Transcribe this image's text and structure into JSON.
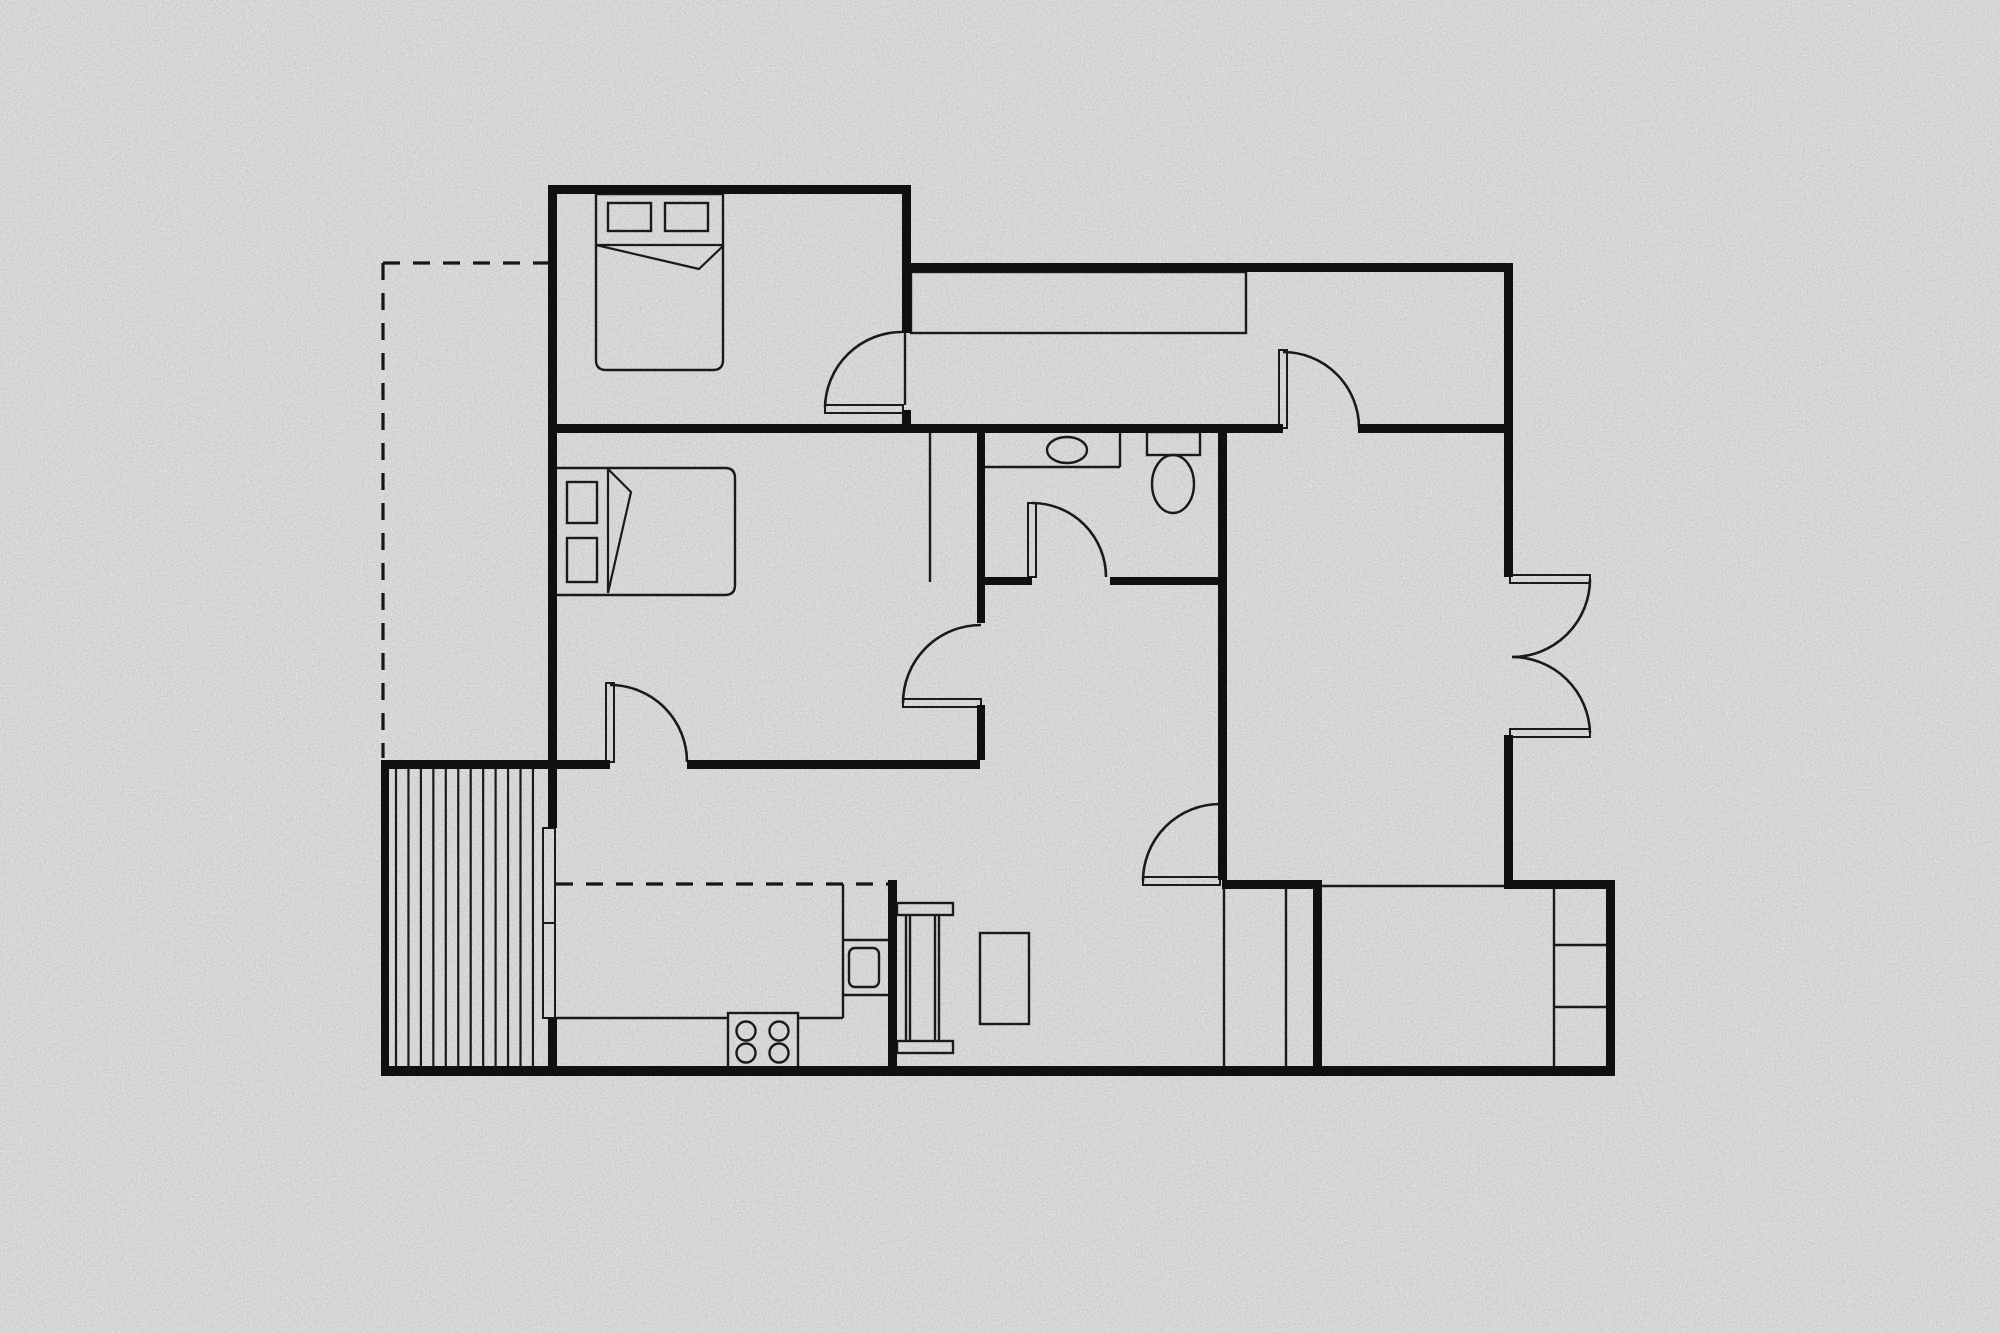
{
  "meta": {
    "title": "apartment-floor-plan",
    "canvas": {
      "w": 2000,
      "h": 1333
    }
  },
  "colors": {
    "background": "#cbcbcb",
    "wall": "#101010",
    "line": "#1a1a1a",
    "dash": "#161616"
  },
  "plan": {
    "walls": [
      {
        "name": "bedroom1-north-wall",
        "x": 548,
        "y": 185,
        "w": 363,
        "h": 9
      },
      {
        "name": "west-wall",
        "x": 548,
        "y": 185,
        "w": 9,
        "h": 643
      },
      {
        "name": "west-wall-lower",
        "x": 548,
        "y": 1018,
        "w": 9,
        "h": 58
      },
      {
        "name": "bedroom1-east-wall-upper",
        "x": 902,
        "y": 185,
        "w": 9,
        "h": 148
      },
      {
        "name": "bedroom1-east-wall-stub",
        "x": 902,
        "y": 410,
        "w": 9,
        "h": 23
      },
      {
        "name": "hallway-north-wall",
        "x": 904,
        "y": 263,
        "w": 609,
        "h": 9
      },
      {
        "name": "east-wall-upper",
        "x": 1504,
        "y": 272,
        "w": 9,
        "h": 305
      },
      {
        "name": "east-wall-mid",
        "x": 1504,
        "y": 735,
        "w": 9,
        "h": 154
      },
      {
        "name": "main-cross-wall-west",
        "x": 548,
        "y": 424,
        "w": 735,
        "h": 9
      },
      {
        "name": "main-cross-wall-east",
        "x": 1358,
        "y": 424,
        "w": 146,
        "h": 9
      },
      {
        "name": "bathroom-west-wall",
        "x": 977,
        "y": 433,
        "w": 8,
        "h": 190
      },
      {
        "name": "bathroom-west-wall-stub",
        "x": 977,
        "y": 705,
        "w": 8,
        "h": 55
      },
      {
        "name": "bathroom-south-wall-west",
        "x": 985,
        "y": 577,
        "w": 47,
        "h": 8
      },
      {
        "name": "bathroom-south-wall-east",
        "x": 1110,
        "y": 577,
        "w": 112,
        "h": 8
      },
      {
        "name": "livingroom-west-wall",
        "x": 1218,
        "y": 433,
        "w": 9,
        "h": 447
      },
      {
        "name": "deck-north-wall",
        "x": 381,
        "y": 760,
        "w": 229,
        "h": 9
      },
      {
        "name": "bedroom2-south-wall",
        "x": 687,
        "y": 760,
        "w": 293,
        "h": 9
      },
      {
        "name": "deck-west-wall",
        "x": 381,
        "y": 760,
        "w": 8,
        "h": 316
      },
      {
        "name": "south-wall",
        "x": 381,
        "y": 1066,
        "w": 1234,
        "h": 10
      },
      {
        "name": "kitchen-east-wall",
        "x": 888,
        "y": 880,
        "w": 9,
        "h": 186
      },
      {
        "name": "dining-closet-north-wall",
        "x": 1222,
        "y": 880,
        "w": 100,
        "h": 9
      },
      {
        "name": "dining-closet-east-wall",
        "x": 1313,
        "y": 880,
        "w": 9,
        "h": 186
      },
      {
        "name": "bottomright-north-wall",
        "x": 1507,
        "y": 880,
        "w": 108,
        "h": 9
      },
      {
        "name": "bottomright-east-wall",
        "x": 1606,
        "y": 880,
        "w": 9,
        "h": 196
      }
    ],
    "rects": [
      {
        "name": "hallway-closet",
        "x": 911,
        "y": 272,
        "w": 335,
        "h": 61,
        "sw": 2.4
      },
      {
        "name": "bed1-pillow-left",
        "x": 608,
        "y": 203,
        "w": 43,
        "h": 28,
        "sw": 2.4
      },
      {
        "name": "bed1-pillow-right",
        "x": 665,
        "y": 203,
        "w": 43,
        "h": 28,
        "sw": 2.4
      },
      {
        "name": "bed2-pillow-top",
        "x": 567,
        "y": 482,
        "w": 30,
        "h": 41,
        "sw": 2.4
      },
      {
        "name": "bed2-pillow-bottom",
        "x": 567,
        "y": 538,
        "w": 30,
        "h": 44,
        "sw": 2.4
      },
      {
        "name": "toilet-tank",
        "x": 1147,
        "y": 432,
        "w": 53,
        "h": 23,
        "sw": 2.4
      },
      {
        "name": "kitchen-sink",
        "x": 849,
        "y": 948,
        "w": 30,
        "h": 39,
        "rx": 6,
        "sw": 2.4
      },
      {
        "name": "stove",
        "x": 728,
        "y": 1013,
        "w": 70,
        "h": 59,
        "sw": 2.4
      },
      {
        "name": "dining-table-end-north",
        "x": 897,
        "y": 903,
        "w": 56,
        "h": 12,
        "sw": 2.4
      },
      {
        "name": "dining-table-end-south",
        "x": 897,
        "y": 1041,
        "w": 56,
        "h": 12,
        "sw": 2.4
      },
      {
        "name": "coffee-table",
        "x": 980,
        "y": 933,
        "w": 49,
        "h": 91,
        "sw": 2.4
      },
      {
        "name": "sliding-door-panel-upper",
        "x": 543,
        "y": 828,
        "w": 12,
        "h": 95,
        "sw": 2
      },
      {
        "name": "sliding-door-panel-lower",
        "x": 543,
        "y": 923,
        "w": 12,
        "h": 95,
        "sw": 2
      }
    ],
    "door_leaves": [
      {
        "name": "bedroom1-door-leaf",
        "x": 825,
        "y": 405,
        "w": 78,
        "h": 8
      },
      {
        "name": "hallway-door-leaf",
        "x": 1279,
        "y": 350,
        "w": 8,
        "h": 78
      },
      {
        "name": "bathroom-door-leaf",
        "x": 1028,
        "y": 503,
        "w": 8,
        "h": 74
      },
      {
        "name": "bedroom2-east-door-leaf",
        "x": 903,
        "y": 699,
        "w": 78,
        "h": 8
      },
      {
        "name": "bedroom2-south-door-leaf",
        "x": 606,
        "y": 683,
        "w": 8,
        "h": 79
      },
      {
        "name": "dining-door-leaf",
        "x": 1143,
        "y": 877,
        "w": 77,
        "h": 8
      },
      {
        "name": "french-door-leaf-north",
        "x": 1510,
        "y": 575,
        "w": 80,
        "h": 8
      },
      {
        "name": "french-door-leaf-south",
        "x": 1510,
        "y": 729,
        "w": 80,
        "h": 8
      }
    ],
    "lines": [
      {
        "name": "bedroom2-closet-line",
        "x1": 930,
        "y1": 433,
        "x2": 930,
        "y2": 582
      },
      {
        "name": "bedroom1-door-jamb-line",
        "x1": 905,
        "y1": 333,
        "x2": 905,
        "y2": 405
      },
      {
        "name": "open-passage-line",
        "x1": 1322,
        "y1": 886,
        "x2": 1507,
        "y2": 886
      },
      {
        "name": "dining-closet-line-left",
        "x1": 1224,
        "y1": 889,
        "x2": 1224,
        "y2": 1066
      },
      {
        "name": "dining-closet-line-right",
        "x1": 1286,
        "y1": 889,
        "x2": 1286,
        "y2": 1066
      },
      {
        "name": "br-closet-side",
        "x1": 1554,
        "y1": 889,
        "x2": 1554,
        "y2": 1066
      },
      {
        "name": "br-closet-shelf-1",
        "x1": 1554,
        "y1": 945,
        "x2": 1606,
        "y2": 945
      },
      {
        "name": "br-closet-shelf-2",
        "x1": 1554,
        "y1": 1007,
        "x2": 1606,
        "y2": 1007
      },
      {
        "name": "kitchen-counter-edge-west",
        "x1": 556,
        "y1": 1018,
        "x2": 728,
        "y2": 1018
      },
      {
        "name": "kitchen-counter-edge-east",
        "x1": 798,
        "y1": 1018,
        "x2": 843,
        "y2": 1018
      },
      {
        "name": "kitchen-counter-return",
        "x1": 843,
        "y1": 884,
        "x2": 843,
        "y2": 1018
      },
      {
        "name": "kitchen-counter-divider-1",
        "x1": 843,
        "y1": 940,
        "x2": 888,
        "y2": 940
      },
      {
        "name": "kitchen-counter-divider-2",
        "x1": 843,
        "y1": 995,
        "x2": 888,
        "y2": 995
      },
      {
        "name": "vanity-front-edge",
        "x1": 985,
        "y1": 467,
        "x2": 1120,
        "y2": 467
      },
      {
        "name": "vanity-side-edge",
        "x1": 1120,
        "y1": 433,
        "x2": 1120,
        "y2": 467
      },
      {
        "name": "dining-table-rail-1",
        "x1": 906,
        "y1": 915,
        "x2": 906,
        "y2": 1041
      },
      {
        "name": "dining-table-rail-2",
        "x1": 910,
        "y1": 915,
        "x2": 910,
        "y2": 1041
      },
      {
        "name": "dining-table-rail-3",
        "x1": 935,
        "y1": 915,
        "x2": 935,
        "y2": 1041
      },
      {
        "name": "dining-table-rail-4",
        "x1": 939,
        "y1": 915,
        "x2": 939,
        "y2": 1041
      }
    ],
    "dashed_lines": [
      {
        "name": "extension-dashed-west",
        "x1": 383,
        "y1": 263,
        "x2": 383,
        "y2": 758
      },
      {
        "name": "extension-dashed-north",
        "x1": 383,
        "y1": 263,
        "x2": 548,
        "y2": 263
      },
      {
        "name": "kitchen-dashed-line",
        "x1": 556,
        "y1": 884,
        "x2": 888,
        "y2": 884
      }
    ],
    "ellipses": [
      {
        "name": "vanity-basin",
        "cx": 1067,
        "cy": 450,
        "rx": 20,
        "ry": 13
      },
      {
        "name": "toilet-bowl",
        "cx": 1173,
        "cy": 484,
        "rx": 21,
        "ry": 29
      }
    ],
    "circles": [
      {
        "name": "stove-burner-1",
        "cx": 746,
        "cy": 1031,
        "r": 9.5
      },
      {
        "name": "stove-burner-2",
        "cx": 779,
        "cy": 1031,
        "r": 9.5
      },
      {
        "name": "stove-burner-3",
        "cx": 746,
        "cy": 1053,
        "r": 9.5
      },
      {
        "name": "stove-burner-4",
        "cx": 779,
        "cy": 1053,
        "r": 9.5
      }
    ],
    "paths": [
      {
        "name": "bed1-outline",
        "d": "M596,194 L723,194 L723,360 Q723,370 713,370 L606,370 Q596,370 596,360 Z",
        "sw": 2.4
      },
      {
        "name": "bed1-fold",
        "d": "M596,245 L723,245 M596,245 L699,269 L723,246",
        "sw": 2.2
      },
      {
        "name": "bed2-outline",
        "d": "M555,468 L725,468 Q735,468 735,478 L735,585 Q735,595 725,595 L555,595 Z",
        "sw": 2.4
      },
      {
        "name": "bed2-fold",
        "d": "M608,469 L608,593 M608,469 L631,492 L608,593",
        "sw": 2.2
      },
      {
        "name": "bedroom1-door-arc",
        "d": "M825,407 A77,77 0 0 1 902,332",
        "sw": 2.6
      },
      {
        "name": "hallway-door-arc",
        "d": "M1283,352 A76,76 0 0 1 1359,428",
        "sw": 2.6
      },
      {
        "name": "bathroom-door-arc",
        "d": "M1032,503 A74,74 0 0 1 1106,577",
        "sw": 2.6
      },
      {
        "name": "bedroom2-east-door-arc",
        "d": "M903,703 A78,78 0 0 1 981,625",
        "sw": 2.6
      },
      {
        "name": "bedroom2-south-door-arc",
        "d": "M610,685 A77,77 0 0 1 687,762",
        "sw": 2.6
      },
      {
        "name": "dining-door-arc",
        "d": "M1143,881 A77,77 0 0 1 1220,804",
        "sw": 2.6
      },
      {
        "name": "french-door-arc-north",
        "d": "M1590,579 A78,78 0 0 1 1512,657",
        "sw": 2.6
      },
      {
        "name": "french-door-arc-south",
        "d": "M1590,733 A78,78 0 0 0 1512,657",
        "sw": 2.6
      }
    ],
    "hatch": {
      "name": "deck-board-hatch",
      "x_start": 396,
      "x_end": 545,
      "step": 12.45,
      "y1": 769,
      "y2": 1066,
      "sw": 2.2
    }
  }
}
